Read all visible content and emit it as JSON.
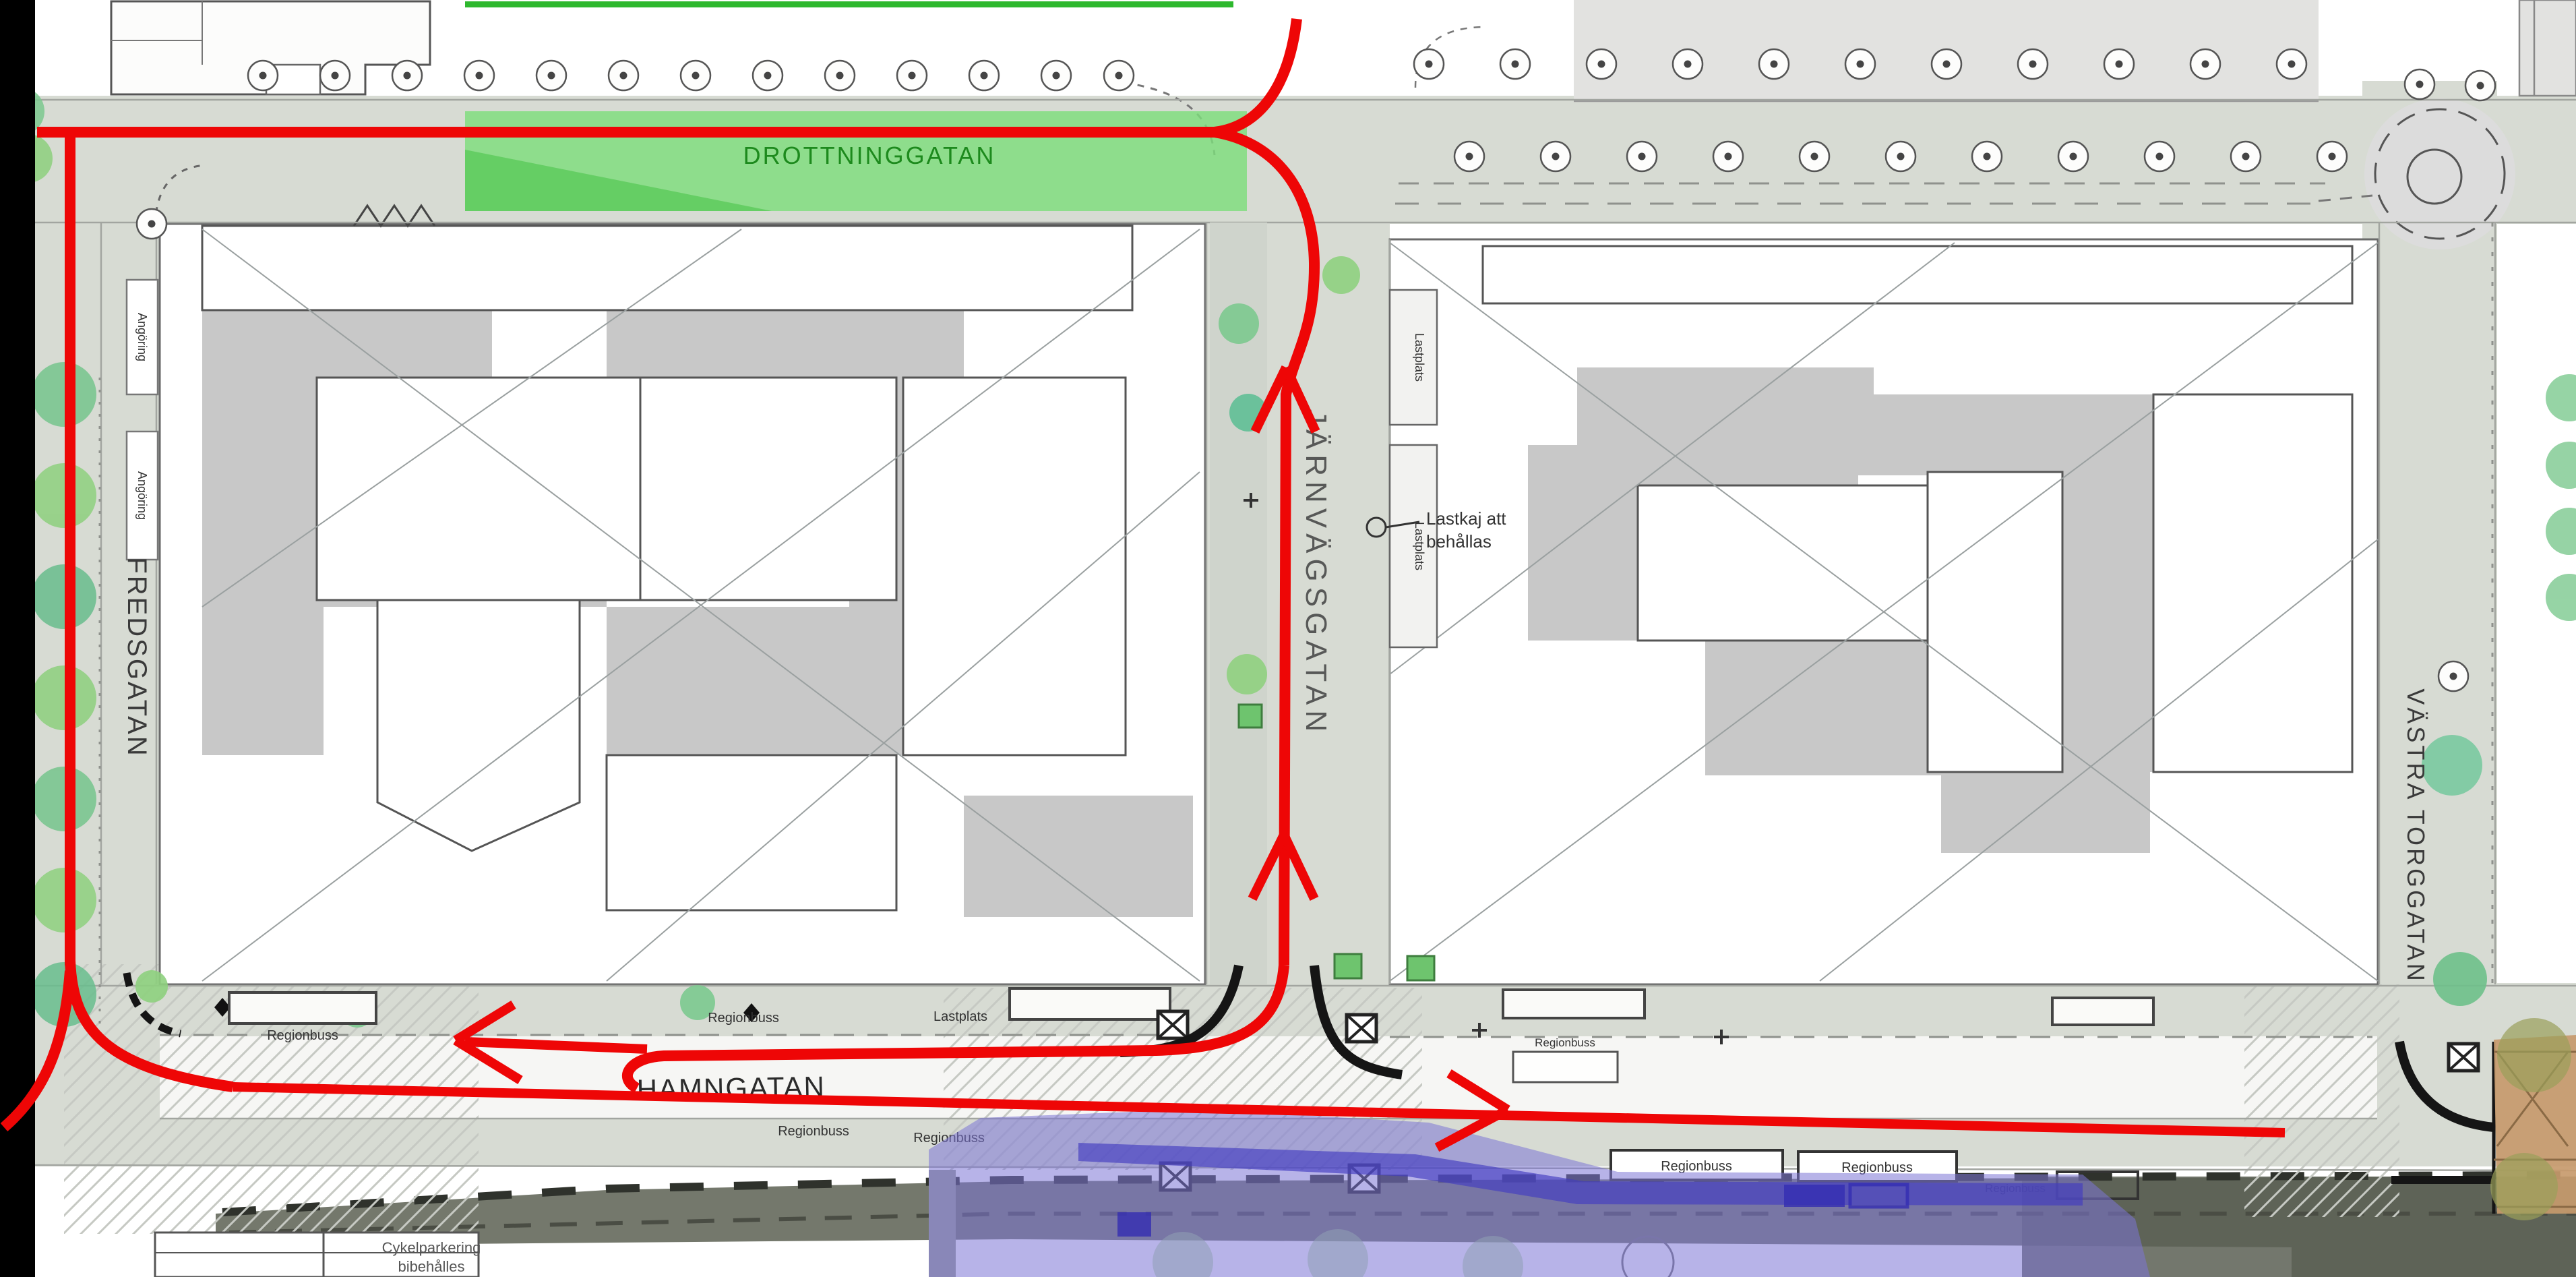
{
  "map": {
    "streets": {
      "drottninggatan": "DROTTNINGGATAN",
      "fredsgatan": "FREDSGATAN",
      "jarnvagsgatan": "JÄRNVÄGSGATAN",
      "hamngatan": "HAMNGATAN",
      "vastra_torggatan": "VÄSTRA TORGGATAN"
    },
    "labels": {
      "regionbus": "Regionbuss",
      "lastplats": "Lastplats",
      "angoring": "Angöring",
      "callout_line1": "Lastkaj att",
      "callout_line2": "behållas",
      "note_line1": "Cykelparkering",
      "note_line2": "bibehålles"
    },
    "colors": {
      "route_red": "#ee0606",
      "overlay_green": "#7edd7d",
      "overlay_green_dark": "#3cbf3c",
      "green_text": "#1d8a1d",
      "overlay_blue": "#7b74d6",
      "overlay_blue_dark": "#423cc0",
      "brown_area": "#c79a6c",
      "edge_black": "#000000"
    }
  }
}
